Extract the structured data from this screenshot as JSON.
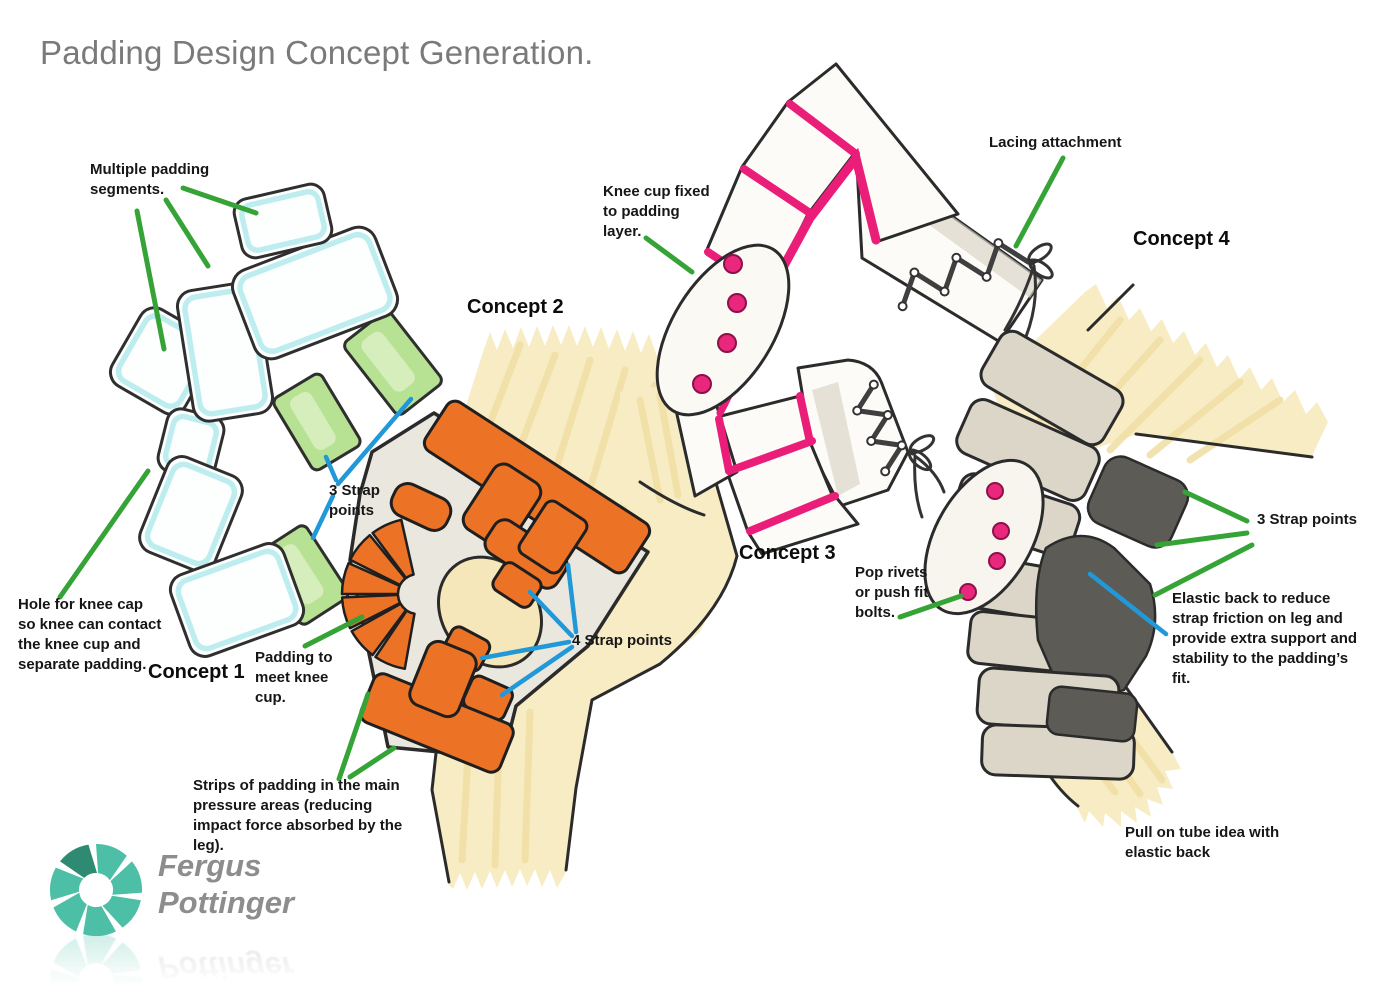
{
  "title": "Padding Design Concept Generation.",
  "concepts": {
    "c1": "Concept 1",
    "c2": "Concept 2",
    "c3": "Concept 3",
    "c4": "Concept 4"
  },
  "annotations": {
    "multiple_padding": "Multiple padding\nsegments.",
    "hole_for_knee_cap": "Hole for knee cap\nso knee can contact\nthe knee cup and\nseparate padding.",
    "strap_points_c1": "3 Strap\npoints",
    "padding_to_meet": "Padding to\nmeet knee\ncup.",
    "strap_points_c2": "4 Strap points",
    "strips_of_padding": "Strips of padding in the main\npressure areas (reducing\nimpact force absorbed by the\nleg).",
    "knee_cup_fixed": "Knee cup fixed\nto padding\nlayer.",
    "lacing_attachment": "Lacing attachment",
    "pop_rivets": "Pop rivets\nor push fit\nbolts.",
    "strap_points_c4": "3 Strap points",
    "elastic_back": "Elastic back to reduce\nstrap friction on leg and\nprovide extra support and\nstability to the padding’s\nfit.",
    "pull_on_tube": "Pull on tube idea with\nelastic back"
  },
  "logo": {
    "first_name": "Fergus",
    "last_name": "Pottinger"
  },
  "colors": {
    "title_gray": "#7a7a7a",
    "annotation_line_green": "#36a336",
    "strap_line_blue": "#2198d8",
    "concept1_edge_cyan": "#b9ecee",
    "concept1_strap_green": "#b7e294",
    "concept2_orange": "#ec7326",
    "concept3_pink": "#ea1d78",
    "concept4_dark_gray": "#5d5b56",
    "leg_cream": "#f8ecc4",
    "logo_teal": "#4dbfa6",
    "logo_teal_dark": "#2f8a72"
  }
}
